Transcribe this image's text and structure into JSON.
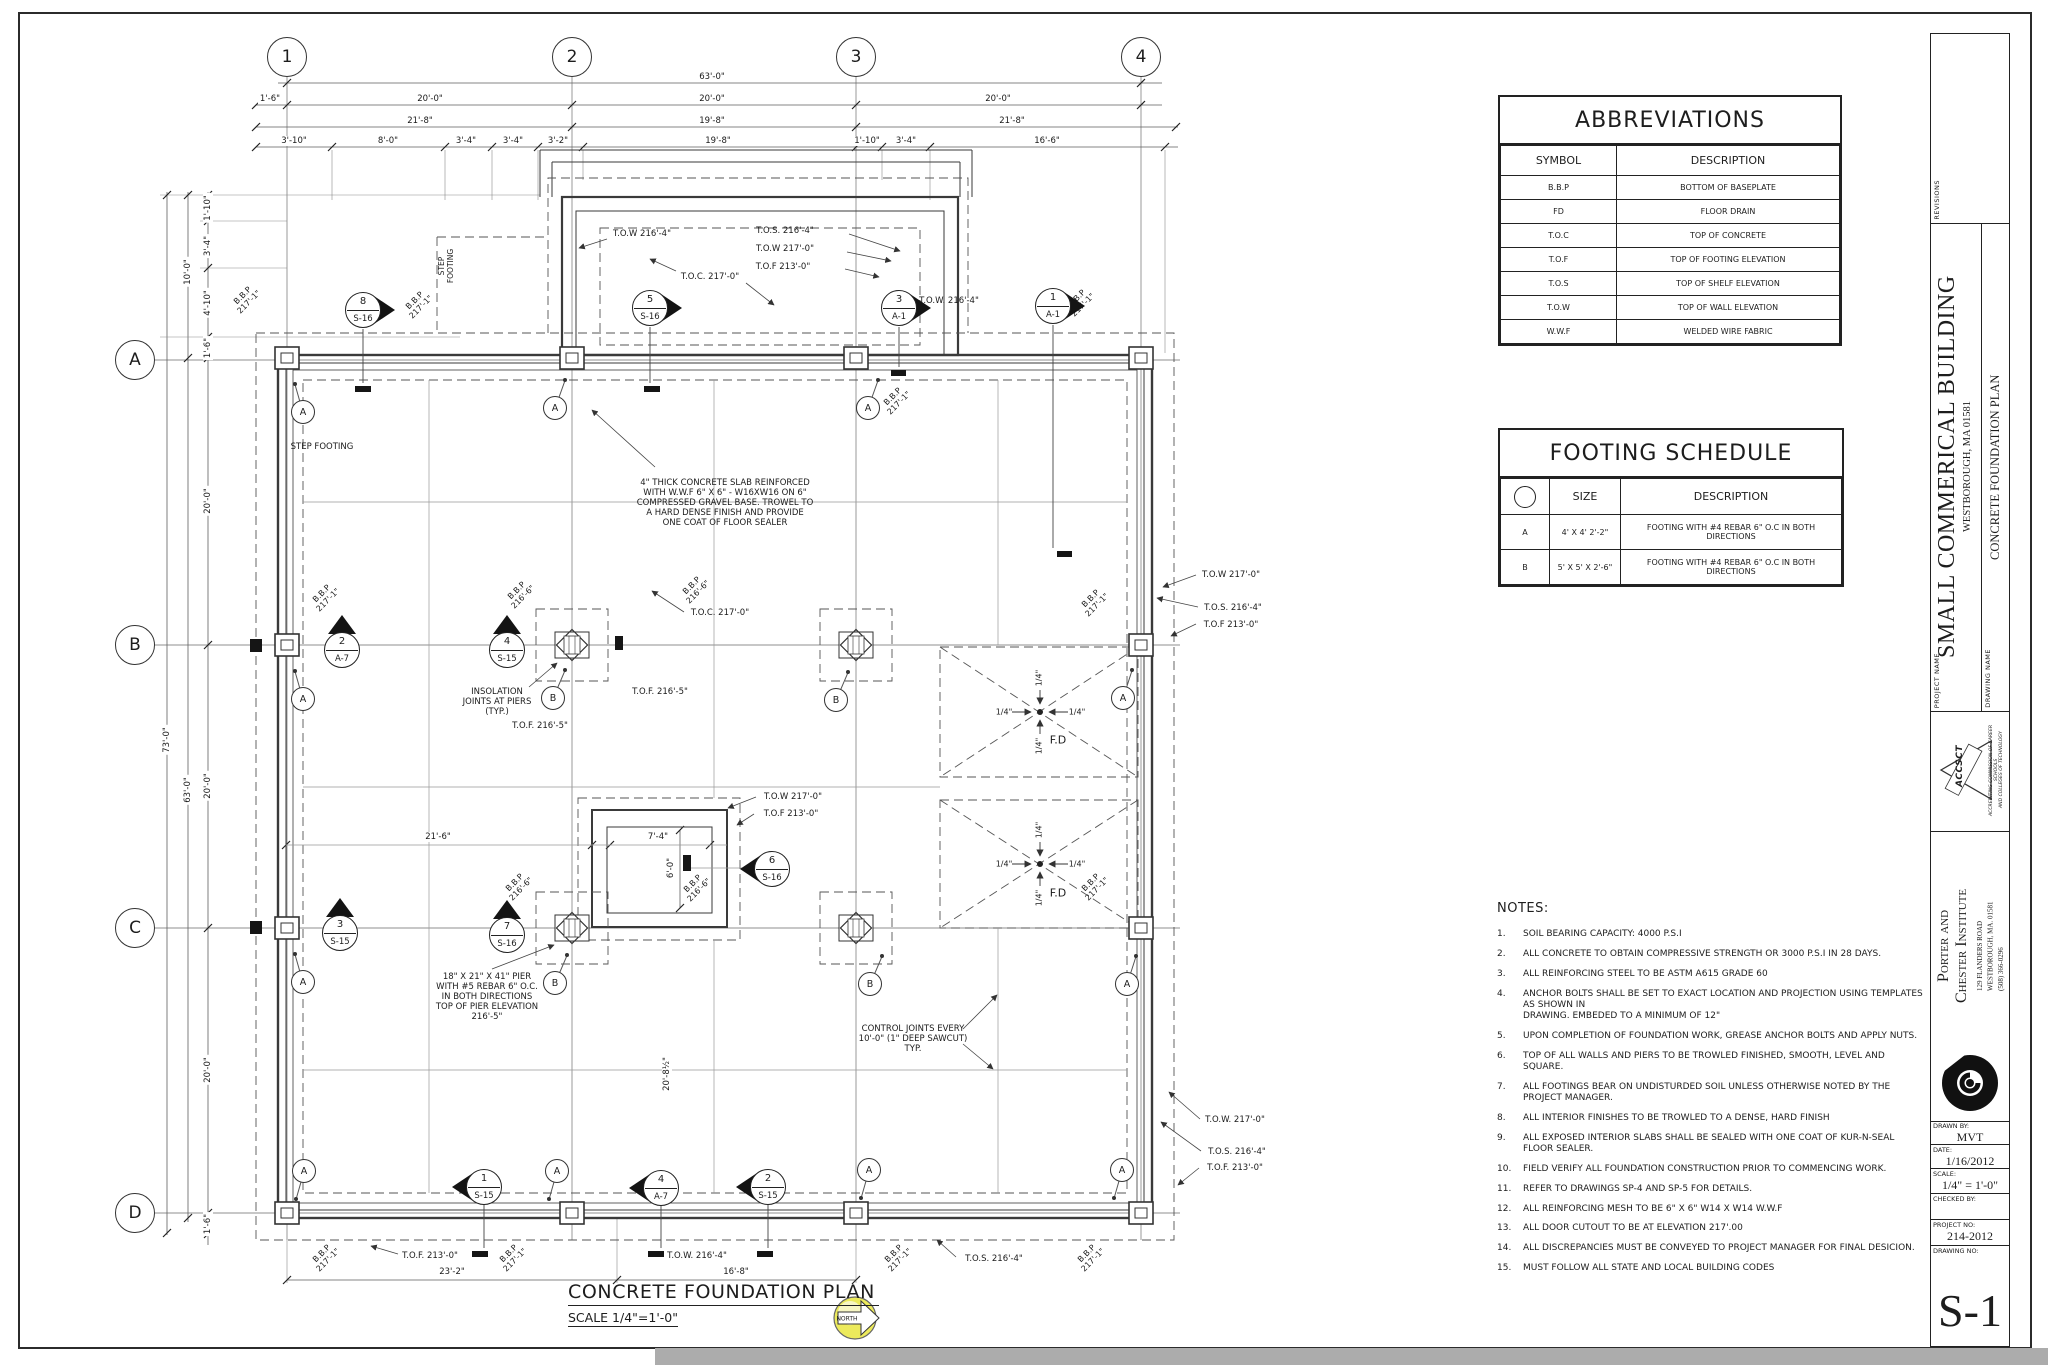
{
  "sheet": {
    "tables": {
      "abbreviations": {
        "title": "ABBREVIATIONS",
        "headers": [
          "SYMBOL",
          "DESCRIPTION"
        ],
        "rows": [
          [
            "B.B.P",
            "BOTTOM OF BASEPLATE"
          ],
          [
            "FD",
            "FLOOR DRAIN"
          ],
          [
            "T.O.C",
            "TOP OF CONCRETE"
          ],
          [
            "T.O.F",
            "TOP OF FOOTING ELEVATION"
          ],
          [
            "T.O.S",
            "TOP OF SHELF ELEVATION"
          ],
          [
            "T.O.W",
            "TOP OF WALL ELEVATION"
          ],
          [
            "W.W.F",
            "WELDED WIRE FABRIC"
          ]
        ]
      },
      "footing_schedule": {
        "title": "FOOTING SCHEDULE",
        "headers": [
          "",
          "SIZE",
          "DESCRIPTION"
        ],
        "rows": [
          [
            "A",
            "4' X 4' 2'-2\"",
            "FOOTING WITH #4 REBAR 6\" O.C IN BOTH DIRECTIONS"
          ],
          [
            "B",
            "5' X 5' X 2'-6\"",
            "FOOTING WITH #4 REBAR 6\" O.C IN BOTH DIRECTIONS"
          ]
        ]
      }
    },
    "notes": {
      "title": "NOTES:",
      "items": [
        "SOIL BEARING CAPACITY: 4000 P.S.I",
        "ALL CONCRETE TO OBTAIN COMPRESSIVE STRENGTH OR 3000 P.S.I IN 28 DAYS.",
        "ALL REINFORCING STEEL TO BE ASTM A615 GRADE 60",
        "ANCHOR BOLTS SHALL BE SET TO EXACT LOCATION AND PROJECTION USING TEMPLATES AS SHOWN IN\nDRAWING.  EMBEDED TO A MINIMUM OF 12\"",
        "UPON COMPLETION OF FOUNDATION WORK, GREASE ANCHOR BOLTS AND APPLY NUTS.",
        "TOP OF ALL WALLS AND PIERS TO BE TROWLED FINISHED, SMOOTH, LEVEL AND SQUARE.",
        "ALL FOOTINGS BEAR ON UNDISTURDED SOIL UNLESS OTHERWISE NOTED BY THE PROJECT MANAGER.",
        "ALL INTERIOR FINISHES TO BE TROWLED TO A DENSE, HARD FINISH",
        "ALL EXPOSED INTERIOR SLABS SHALL BE SEALED WITH ONE COAT OF KUR-N-SEAL FLOOR SEALER.",
        "FIELD VERIFY ALL FOUNDATION CONSTRUCTION PRIOR TO COMMENCING WORK.",
        "REFER TO DRAWINGS SP-4 AND SP-5 FOR DETAILS.",
        "ALL REINFORCING MESH TO BE 6\" X 6\" W14 X W14 W.W.F",
        "ALL DOOR CUTOUT TO BE AT ELEVATION 217'.00",
        "ALL DISCREPANCIES MUST BE CONVEYED TO PROJECT MANAGER FOR FINAL DESICION.",
        "MUST FOLLOW ALL STATE AND LOCAL BUILDING CODES"
      ]
    },
    "titleblock": {
      "revisions_label": "REVISIONS",
      "project_name_label": "PROJECT  NAME",
      "project_name": "SMALL COMMERICAL BUILDING",
      "project_address": "WESTBOROUGH, MA 01581",
      "drawing_name_label": "DRAWING  NAME",
      "drawing_name": "CONCRETE FOUNDATION PLAN",
      "accsct": {
        "name": "ACCSCT",
        "line1": "ACCREDITING COMMISSION OF CAREER SCHOOLS",
        "line2": "AND COLLEGES OF TECHNOLOGY"
      },
      "firm_name1": "Porter and",
      "firm_name2": "Chester Institute",
      "firm_address": "129 FLANDERS ROAD\nWESTBOROUGH, MA. 01581\n(508) 366-0296",
      "fields": [
        {
          "label": "DRAWN  BY:",
          "value": "MVT"
        },
        {
          "label": "DATE:",
          "value": "1/16/2012"
        },
        {
          "label": "SCALE:",
          "value": "1/4\" = 1'-0\""
        },
        {
          "label": "CHECKED  BY:",
          "value": ""
        },
        {
          "label": "PROJECT  NO:",
          "value": "214-2012"
        },
        {
          "label": "DRAWING  NO:",
          "value": "S-1"
        }
      ]
    }
  },
  "plan": {
    "title": "CONCRETE FOUNDATION PLAN",
    "scale": "SCALE 1/4\"=1'-0\"",
    "north_label": "NORTH",
    "grid_cols": [
      {
        "label": "1",
        "x": 287
      },
      {
        "label": "2",
        "x": 572
      },
      {
        "label": "3",
        "x": 856
      },
      {
        "label": "4",
        "x": 1141
      }
    ],
    "grid_rows": [
      {
        "label": "A",
        "y": 360
      },
      {
        "label": "B",
        "y": 645
      },
      {
        "label": "C",
        "y": 928
      },
      {
        "label": "D",
        "y": 1213
      }
    ],
    "texts": [
      {
        "t": "63'-0\"",
        "x": 712,
        "y": 77,
        "bg": 1
      },
      {
        "t": "1'-6\"",
        "x": 270,
        "y": 99,
        "bg": 1
      },
      {
        "t": "20'-0\"",
        "x": 430,
        "y": 99,
        "bg": 1
      },
      {
        "t": "20'-0\"",
        "x": 712,
        "y": 99,
        "bg": 1
      },
      {
        "t": "20'-0\"",
        "x": 998,
        "y": 99,
        "bg": 1
      },
      {
        "t": "21'-8\"",
        "x": 420,
        "y": 121,
        "bg": 1
      },
      {
        "t": "19'-8\"",
        "x": 712,
        "y": 121,
        "bg": 1
      },
      {
        "t": "21'-8\"",
        "x": 1012,
        "y": 121,
        "bg": 1
      },
      {
        "t": "3'-10\"",
        "x": 294,
        "y": 141,
        "bg": 1
      },
      {
        "t": "8'-0\"",
        "x": 388,
        "y": 141,
        "bg": 1
      },
      {
        "t": "3'-4\"",
        "x": 466,
        "y": 141,
        "bg": 1
      },
      {
        "t": "3'-4\"",
        "x": 513,
        "y": 141,
        "bg": 1
      },
      {
        "t": "3'-2\"",
        "x": 558,
        "y": 141,
        "bg": 1
      },
      {
        "t": "19'-8\"",
        "x": 718,
        "y": 141,
        "bg": 1
      },
      {
        "t": "1'-10\"",
        "x": 867,
        "y": 141,
        "bg": 1
      },
      {
        "t": "3'-4\"",
        "x": 906,
        "y": 141,
        "bg": 1
      },
      {
        "t": "16'-6\"",
        "x": 1047,
        "y": 141,
        "bg": 1
      },
      {
        "t": "73'-0\"",
        "x": 167,
        "y": 740,
        "rot": -90,
        "bg": 1
      },
      {
        "t": "10'-0\"",
        "x": 188,
        "y": 272,
        "rot": -90,
        "bg": 1
      },
      {
        "t": "63'-0\"",
        "x": 188,
        "y": 790,
        "rot": -90,
        "bg": 1
      },
      {
        "t": "1'-10\"",
        "x": 208,
        "y": 208,
        "rot": -90,
        "bg": 1
      },
      {
        "t": "3'-4\"",
        "x": 208,
        "y": 246,
        "rot": -90,
        "bg": 1
      },
      {
        "t": "4'-10\"",
        "x": 208,
        "y": 303,
        "rot": -90,
        "bg": 1
      },
      {
        "t": "1'-6\"",
        "x": 208,
        "y": 348,
        "rot": -90,
        "bg": 1
      },
      {
        "t": "20'-0\"",
        "x": 208,
        "y": 501,
        "rot": -90,
        "bg": 1
      },
      {
        "t": "20'-0\"",
        "x": 208,
        "y": 786,
        "rot": -90,
        "bg": 1
      },
      {
        "t": "20'-0\"",
        "x": 208,
        "y": 1070,
        "rot": -90,
        "bg": 1
      },
      {
        "t": "1'-6\"",
        "x": 208,
        "y": 1224,
        "rot": -90,
        "bg": 1
      },
      {
        "t": "23'-2\"",
        "x": 452,
        "y": 1272,
        "bg": 1
      },
      {
        "t": "16'-8\"",
        "x": 736,
        "y": 1272,
        "bg": 1
      },
      {
        "t": "21'-6\"",
        "x": 438,
        "y": 837,
        "bg": 1
      },
      {
        "t": "7'-4\"",
        "x": 658,
        "y": 837,
        "bg": 1
      },
      {
        "t": "6'-0\"",
        "x": 671,
        "y": 868,
        "rot": -90,
        "bg": 1
      },
      {
        "t": "20'-8½\"",
        "x": 667,
        "y": 1074,
        "rot": -90,
        "bg": 1
      },
      {
        "t": "T.O.W 216'-4\"",
        "x": 642,
        "y": 234
      },
      {
        "t": "T.O.S. 216'-4\"",
        "x": 785,
        "y": 231
      },
      {
        "t": "T.O.W 217'-0\"",
        "x": 785,
        "y": 249
      },
      {
        "t": "T.O.F 213'-0\"",
        "x": 783,
        "y": 267
      },
      {
        "t": "T.O.C. 217'-0\"",
        "x": 710,
        "y": 277
      },
      {
        "t": "T.O.W. 216'-4\"",
        "x": 949,
        "y": 301
      },
      {
        "t": "T.O.W 217'-0\"",
        "x": 1231,
        "y": 575
      },
      {
        "t": "T.O.S. 216'-4\"",
        "x": 1233,
        "y": 608
      },
      {
        "t": "T.O.F 213'-0\"",
        "x": 1231,
        "y": 625
      },
      {
        "t": "T.O.C. 217'-0\"",
        "x": 720,
        "y": 613
      },
      {
        "t": "T.O.F. 216'-5\"",
        "x": 540,
        "y": 726
      },
      {
        "t": "T.O.F. 216'-5\"",
        "x": 660,
        "y": 692
      },
      {
        "t": "T.O.W 217'-0\"",
        "x": 793,
        "y": 797
      },
      {
        "t": "T.O.F 213'-0\"",
        "x": 791,
        "y": 814
      },
      {
        "t": "T.O.W. 217'-0\"",
        "x": 1235,
        "y": 1120
      },
      {
        "t": "T.O.S. 216'-4\"",
        "x": 1237,
        "y": 1152
      },
      {
        "t": "T.O.F. 213'-0\"",
        "x": 1235,
        "y": 1168
      },
      {
        "t": "T.O.F. 213'-0\"",
        "x": 430,
        "y": 1256
      },
      {
        "t": "T.O.W. 216'-4\"",
        "x": 697,
        "y": 1256
      },
      {
        "t": "T.O.S. 216'-4\"",
        "x": 994,
        "y": 1259
      },
      {
        "t": "B.B.P\n217'-1\"",
        "x": 246,
        "y": 299,
        "rot": -45,
        "fs": 8
      },
      {
        "t": "B.B.P\n217'-1\"",
        "x": 418,
        "y": 304,
        "rot": -45,
        "fs": 8
      },
      {
        "t": "B.B.P\n217'-1\"",
        "x": 896,
        "y": 400,
        "rot": -45,
        "fs": 8
      },
      {
        "t": "B.B.P\n217'-1\"",
        "x": 1080,
        "y": 302,
        "rot": -45,
        "fs": 8
      },
      {
        "t": "B.B.P\n217'-1\"",
        "x": 325,
        "y": 597,
        "rot": -45,
        "fs": 8
      },
      {
        "t": "B.B.P\n216'-6\"",
        "x": 520,
        "y": 594,
        "rot": -45,
        "fs": 8
      },
      {
        "t": "B.B.P\n216'-6\"",
        "x": 695,
        "y": 589,
        "rot": -45,
        "fs": 8
      },
      {
        "t": "B.B.P\n217'-1\"",
        "x": 1094,
        "y": 602,
        "rot": -45,
        "fs": 8
      },
      {
        "t": "B.B.P\n216'-6\"",
        "x": 518,
        "y": 886,
        "rot": -45,
        "fs": 8
      },
      {
        "t": "B.B.P\n216'-6\"",
        "x": 696,
        "y": 887,
        "rot": -45,
        "fs": 8
      },
      {
        "t": "B.B.P\n217'-1\"",
        "x": 1094,
        "y": 886,
        "rot": -45,
        "fs": 8
      },
      {
        "t": "B.B.P\n217'-1\"",
        "x": 325,
        "y": 1257,
        "rot": -45,
        "fs": 8
      },
      {
        "t": "B.B.P\n217'-1\"",
        "x": 512,
        "y": 1257,
        "rot": -45,
        "fs": 8
      },
      {
        "t": "B.B.P\n217'-1\"",
        "x": 897,
        "y": 1257,
        "rot": -45,
        "fs": 8
      },
      {
        "t": "B.B.P\n217'-1\"",
        "x": 1090,
        "y": 1257,
        "rot": -45,
        "fs": 8
      },
      {
        "t": "STEP FOOTING",
        "x": 322,
        "y": 447
      },
      {
        "t": "STEP\nFOOTING",
        "x": 447,
        "y": 266,
        "rot": -90,
        "fs": 7.5
      },
      {
        "t": "4\" THICK CONCRETE SLAB REINFORCED\nWITH W.W.F 6\" X 6\" - W16XW16 ON 6\"\nCOMPRESSED GRAVEL BASE. TROWEL TO\nA HARD DENSE FINISH AND PROVIDE\nONE COAT OF FLOOR SEALER",
        "x": 725,
        "y": 503
      },
      {
        "t": "INSOLATION\nJOINTS AT PIERS\n(TYP.)",
        "x": 497,
        "y": 702
      },
      {
        "t": "18\" X 21\" X 41\" PIER\nWITH #5 REBAR 6\" O.C.\nIN BOTH DIRECTIONS\nTOP OF PIER ELEVATION\n216'-5\"",
        "x": 487,
        "y": 997
      },
      {
        "t": "CONTROL JOINTS EVERY\n10'-0\" (1\" DEEP SAWCUT)\nTYP.",
        "x": 913,
        "y": 1039
      },
      {
        "t": "F.D",
        "x": 1058,
        "y": 741,
        "fs": 11
      },
      {
        "t": "F.D",
        "x": 1058,
        "y": 894,
        "fs": 11
      },
      {
        "t": "1/4\"",
        "x": 1004,
        "y": 712,
        "fs": 8
      },
      {
        "t": "1/4\"",
        "x": 1077,
        "y": 712,
        "fs": 8
      },
      {
        "t": "1/4\"",
        "x": 1039,
        "y": 678,
        "rot": -90,
        "fs": 8
      },
      {
        "t": "1/4\"",
        "x": 1039,
        "y": 746,
        "rot": -90,
        "fs": 8
      },
      {
        "t": "1/4\"",
        "x": 1004,
        "y": 864,
        "fs": 8
      },
      {
        "t": "1/4\"",
        "x": 1077,
        "y": 864,
        "fs": 8
      },
      {
        "t": "1/4\"",
        "x": 1039,
        "y": 830,
        "rot": -90,
        "fs": 8
      },
      {
        "t": "1/4\"",
        "x": 1039,
        "y": 898,
        "rot": -90,
        "fs": 8
      }
    ],
    "markers": [
      {
        "n": "8",
        "s": "S-16",
        "x": 363,
        "y": 310,
        "d": "right"
      },
      {
        "n": "5",
        "s": "S-16",
        "x": 650,
        "y": 308,
        "d": "right"
      },
      {
        "n": "3",
        "s": "A-1",
        "x": 899,
        "y": 308,
        "d": "right"
      },
      {
        "n": "1",
        "s": "A-1",
        "x": 1053,
        "y": 306,
        "d": "right"
      },
      {
        "n": "2",
        "s": "A-7",
        "x": 342,
        "y": 650,
        "d": "up"
      },
      {
        "n": "4",
        "s": "S-15",
        "x": 507,
        "y": 650,
        "d": "up"
      },
      {
        "n": "3",
        "s": "S-15",
        "x": 340,
        "y": 933,
        "d": "up"
      },
      {
        "n": "7",
        "s": "S-16",
        "x": 507,
        "y": 935,
        "d": "up"
      },
      {
        "n": "6",
        "s": "S-16",
        "x": 772,
        "y": 869,
        "d": "left"
      },
      {
        "n": "1",
        "s": "S-15",
        "x": 484,
        "y": 1187,
        "d": "left"
      },
      {
        "n": "4",
        "s": "A-7",
        "x": 661,
        "y": 1188,
        "d": "left"
      },
      {
        "n": "2",
        "s": "S-15",
        "x": 768,
        "y": 1187,
        "d": "left"
      }
    ],
    "tags": [
      {
        "t": "A",
        "x": 303,
        "y": 412,
        "dx": -8,
        "dy": -28
      },
      {
        "t": "A",
        "x": 555,
        "y": 408,
        "dx": 10,
        "dy": -28
      },
      {
        "t": "A",
        "x": 868,
        "y": 408,
        "dx": 10,
        "dy": -28
      },
      {
        "t": "A",
        "x": 303,
        "y": 699,
        "dx": -8,
        "dy": -28
      },
      {
        "t": "A",
        "x": 1123,
        "y": 698,
        "dx": 9,
        "dy": -28
      },
      {
        "t": "A",
        "x": 303,
        "y": 982,
        "dx": -8,
        "dy": -28
      },
      {
        "t": "A",
        "x": 1127,
        "y": 984,
        "dx": 9,
        "dy": -28
      },
      {
        "t": "A",
        "x": 304,
        "y": 1171,
        "dx": -8,
        "dy": 28
      },
      {
        "t": "A",
        "x": 557,
        "y": 1171,
        "dx": -8,
        "dy": 28
      },
      {
        "t": "A",
        "x": 869,
        "y": 1170,
        "dx": -8,
        "dy": 28
      },
      {
        "t": "A",
        "x": 1122,
        "y": 1170,
        "dx": -8,
        "dy": 28
      },
      {
        "t": "B",
        "x": 553,
        "y": 698,
        "dx": 12,
        "dy": -28
      },
      {
        "t": "B",
        "x": 836,
        "y": 700,
        "dx": 12,
        "dy": -28
      },
      {
        "t": "B",
        "x": 555,
        "y": 983,
        "dx": 12,
        "dy": -28
      },
      {
        "t": "B",
        "x": 870,
        "y": 984,
        "dx": 12,
        "dy": -28
      }
    ]
  }
}
